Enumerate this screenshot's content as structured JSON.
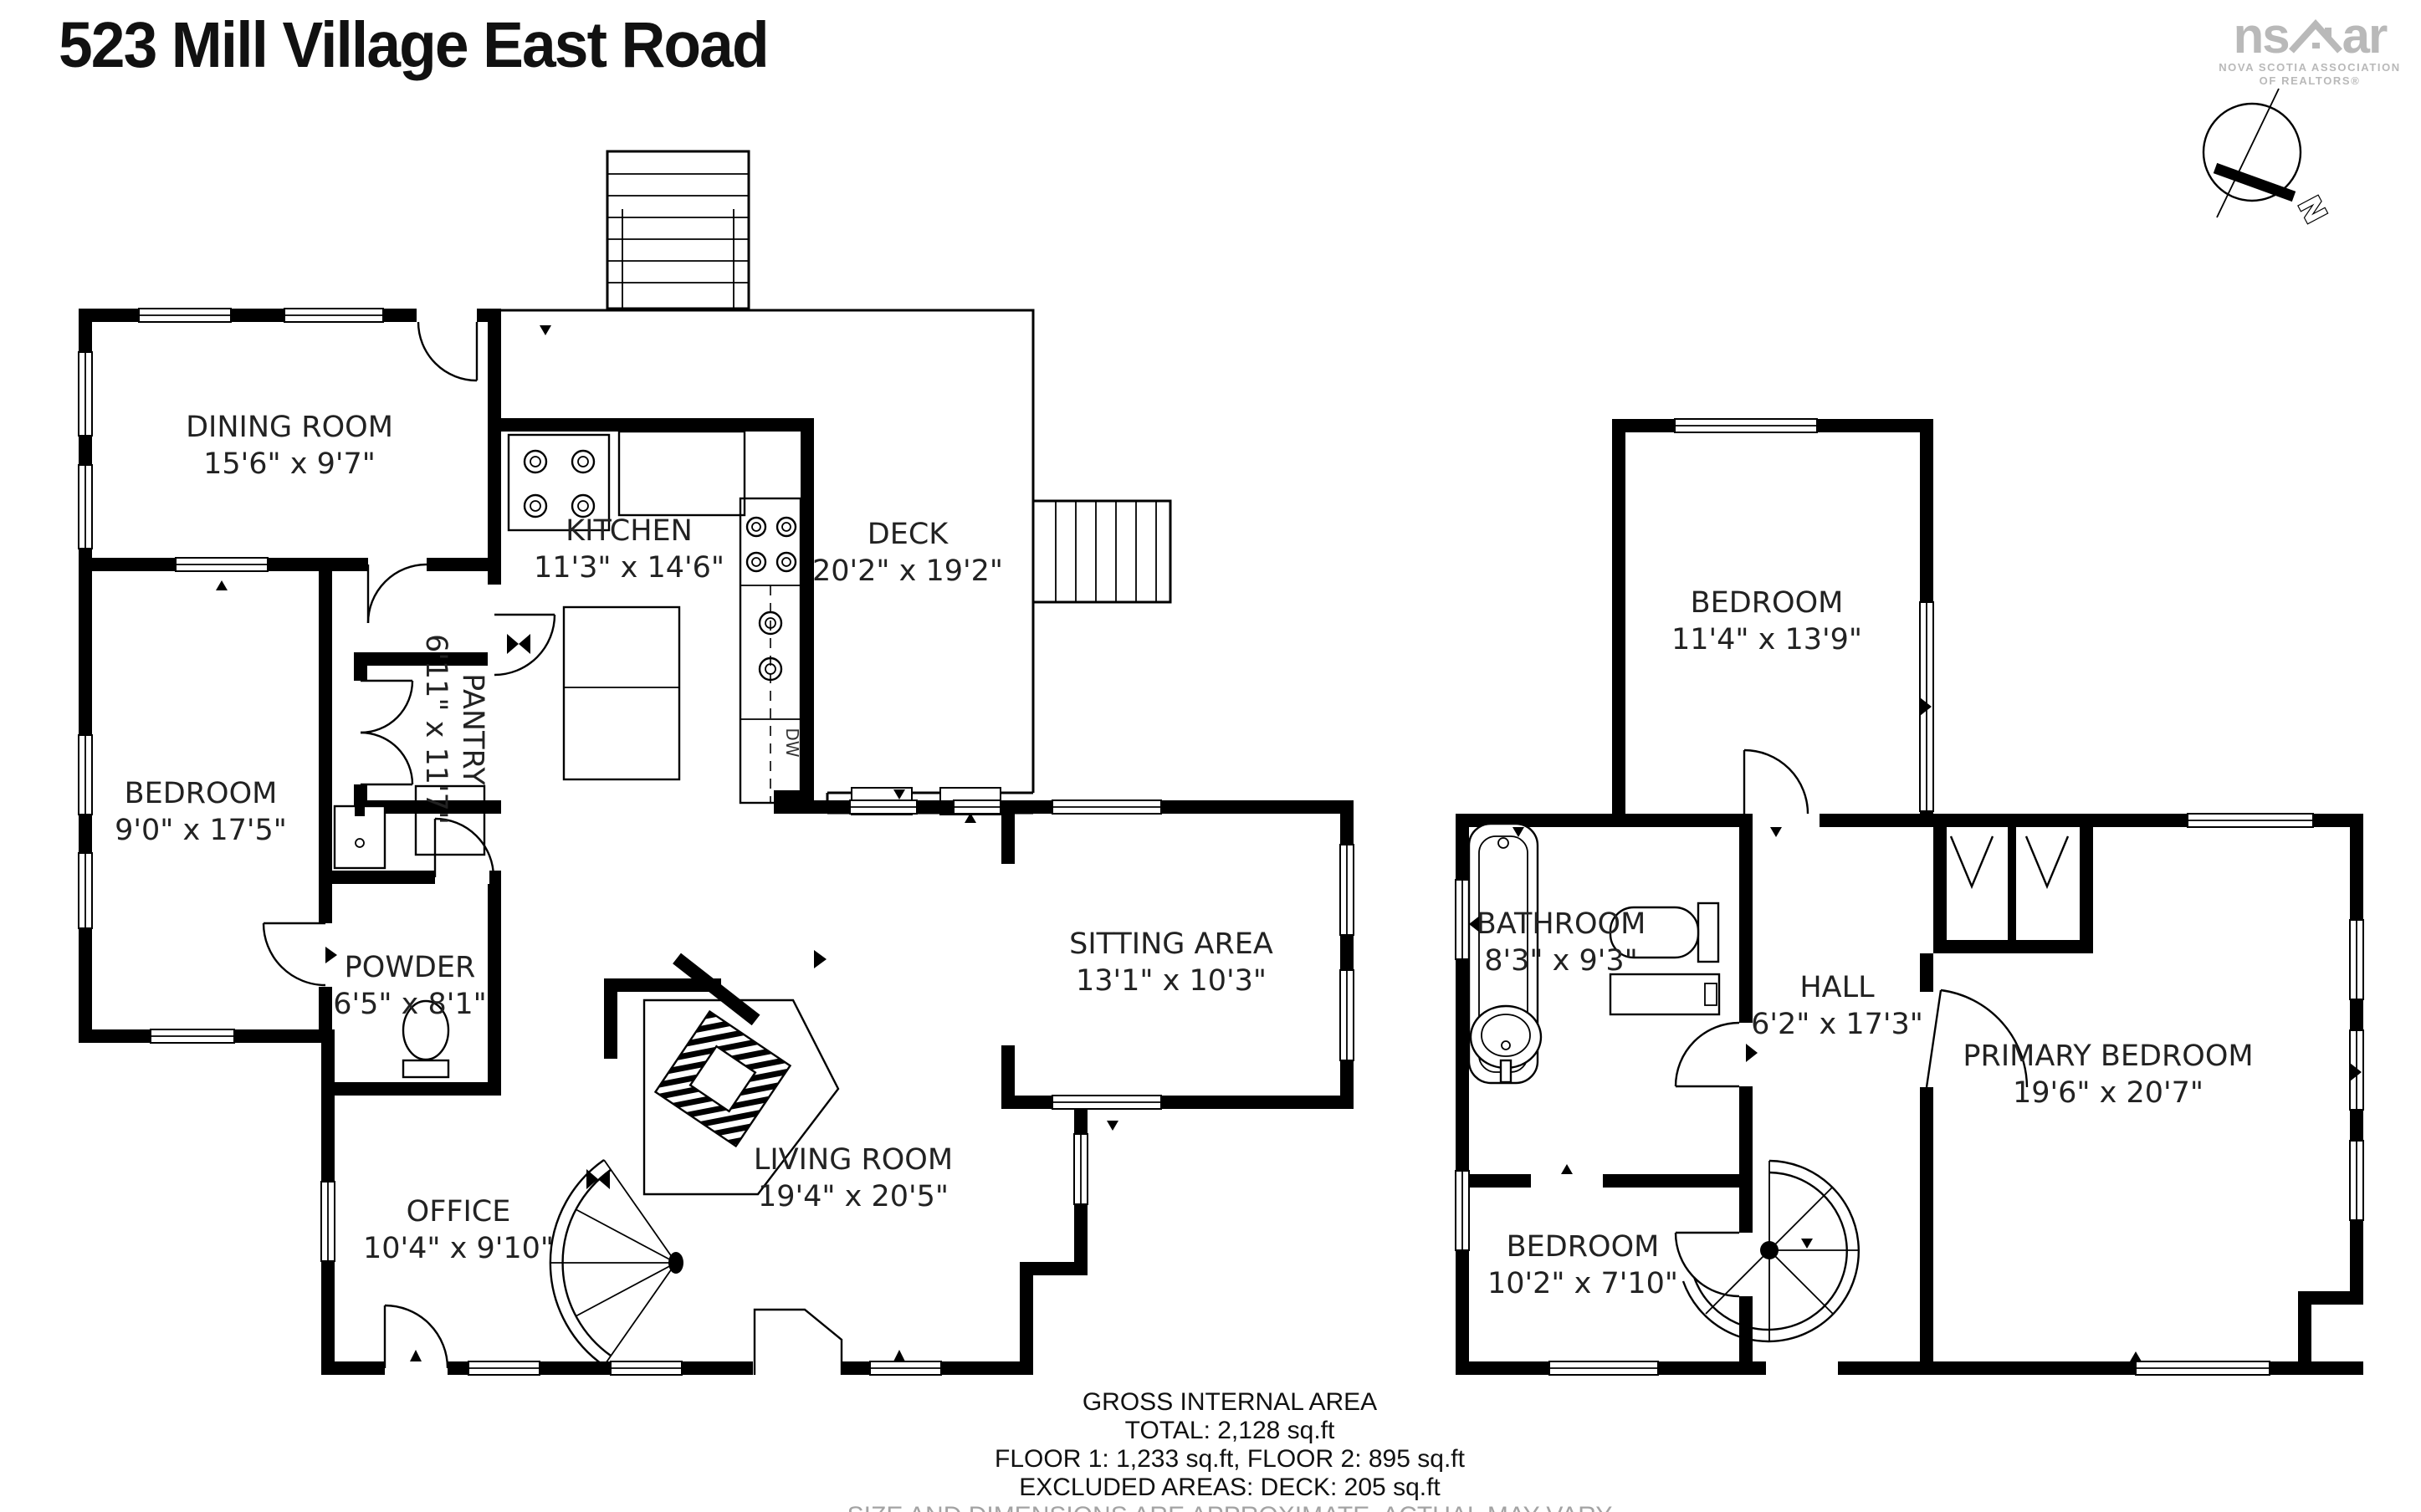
{
  "title": "523 Mill Village East Road",
  "logo": {
    "brand_left": "ns",
    "brand_right": "ar",
    "assoc_line1": "NOVA SCOTIA ASSOCIATION",
    "assoc_line2": "OF REALTORS®"
  },
  "compass": {
    "north_label": "N"
  },
  "colors": {
    "wall": "#000000",
    "logo_gray": "#b9b9b9",
    "label_text": "#222222",
    "disclaimer_gray": "#a3a3a3"
  },
  "floor1": {
    "rooms": [
      {
        "id": "dining-room",
        "name": "DINING ROOM",
        "dims": "15'6\" x 9'7\""
      },
      {
        "id": "kitchen",
        "name": "KITCHEN",
        "dims": "11'3\" x 14'6\""
      },
      {
        "id": "deck",
        "name": "DECK",
        "dims": "20'2\" x 19'2\""
      },
      {
        "id": "pantry",
        "name": "PANTRY",
        "dims": "6'11\" x 11'7\""
      },
      {
        "id": "bedroom",
        "name": "BEDROOM",
        "dims": "9'0\" x 17'5\""
      },
      {
        "id": "powder",
        "name": "POWDER",
        "dims": "6'5\" x 8'1\""
      },
      {
        "id": "sitting-area",
        "name": "SITTING AREA",
        "dims": "13'1\" x 10'3\""
      },
      {
        "id": "living-room",
        "name": "LIVING ROOM",
        "dims": "19'4\" x 20'5\""
      },
      {
        "id": "office",
        "name": "OFFICE",
        "dims": "10'4\" x 9'10\""
      }
    ],
    "appliance_labels": {
      "dishwasher": "DW"
    }
  },
  "floor2": {
    "rooms": [
      {
        "id": "bedroom-top",
        "name": "BEDROOM",
        "dims": "11'4\" x 13'9\""
      },
      {
        "id": "bathroom",
        "name": "BATHROOM",
        "dims": "8'3\" x 9'3\""
      },
      {
        "id": "hall",
        "name": "HALL",
        "dims": "6'2\" x 17'3\""
      },
      {
        "id": "primary-bedroom",
        "name": "PRIMARY BEDROOM",
        "dims": "19'6\" x 20'7\""
      },
      {
        "id": "bedroom-bottom",
        "name": "BEDROOM",
        "dims": "10'2\" x 7'10\""
      }
    ]
  },
  "footer": {
    "heading": "GROSS INTERNAL AREA",
    "total": "TOTAL: 2,128 sq.ft",
    "floors": "FLOOR 1: 1,233 sq.ft, FLOOR 2: 895 sq.ft",
    "excluded": "EXCLUDED AREAS: DECK: 205 sq.ft",
    "disclaimer": "SIZE AND DIMENSIONS ARE APPROXIMATE, ACTUAL MAY VARY"
  }
}
